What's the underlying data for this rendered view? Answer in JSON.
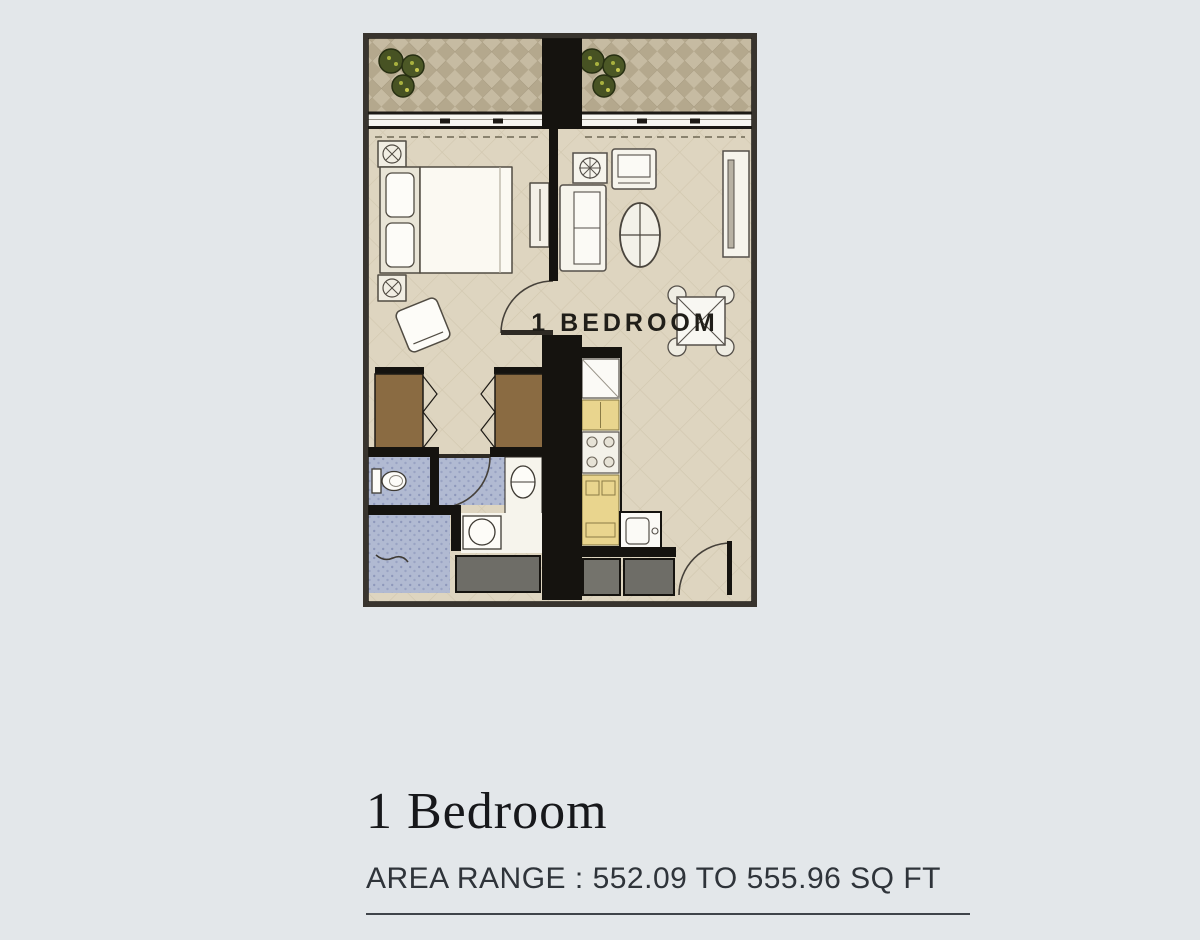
{
  "page": {
    "background_color": "#e3e7ea"
  },
  "floor_plan": {
    "room_label": "1 BEDROOM",
    "colors": {
      "wall": "#15130f",
      "outer_border": "#38342e",
      "floor_tile": "#ded5c0",
      "balcony_tile": "#b4a88d",
      "bathroom_tile": "#b1bad2",
      "wardrobe_brown": "#8a6b42",
      "kitchen_counter_yellow": "#e9d58e",
      "entry_mat_gray": "#6e6d67",
      "plant_green": "#475223",
      "furniture_white": "#f6f4ec"
    }
  },
  "caption": {
    "title": "1 Bedroom",
    "area_range": "AREA RANGE : 552.09 TO 555.96 SQ FT"
  }
}
